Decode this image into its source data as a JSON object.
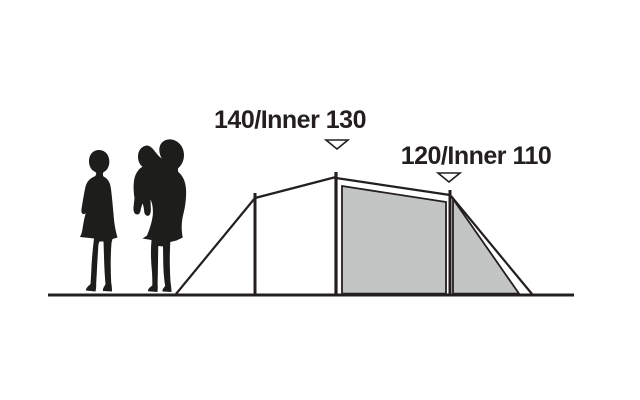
{
  "diagram": {
    "title": "tent-height-dimension-diagram",
    "measurements": [
      {
        "id": "main-peak",
        "label": "140/Inner 130",
        "marker": "down-triangle",
        "points_at": "center-pole"
      },
      {
        "id": "rear-peak",
        "label": "120/Inner 110",
        "marker": "down-triangle",
        "points_at": "rear-pole"
      }
    ],
    "figures": [
      {
        "name": "standing-woman-silhouette"
      },
      {
        "name": "woman-holding-child-silhouette"
      }
    ],
    "colors": {
      "background": "#ffffff",
      "line": "#231f20",
      "panel_fill": "#c3c4c4",
      "silhouette": "#1d1d1b",
      "marker_fill": "#ffffff",
      "text": "#231f20"
    }
  }
}
